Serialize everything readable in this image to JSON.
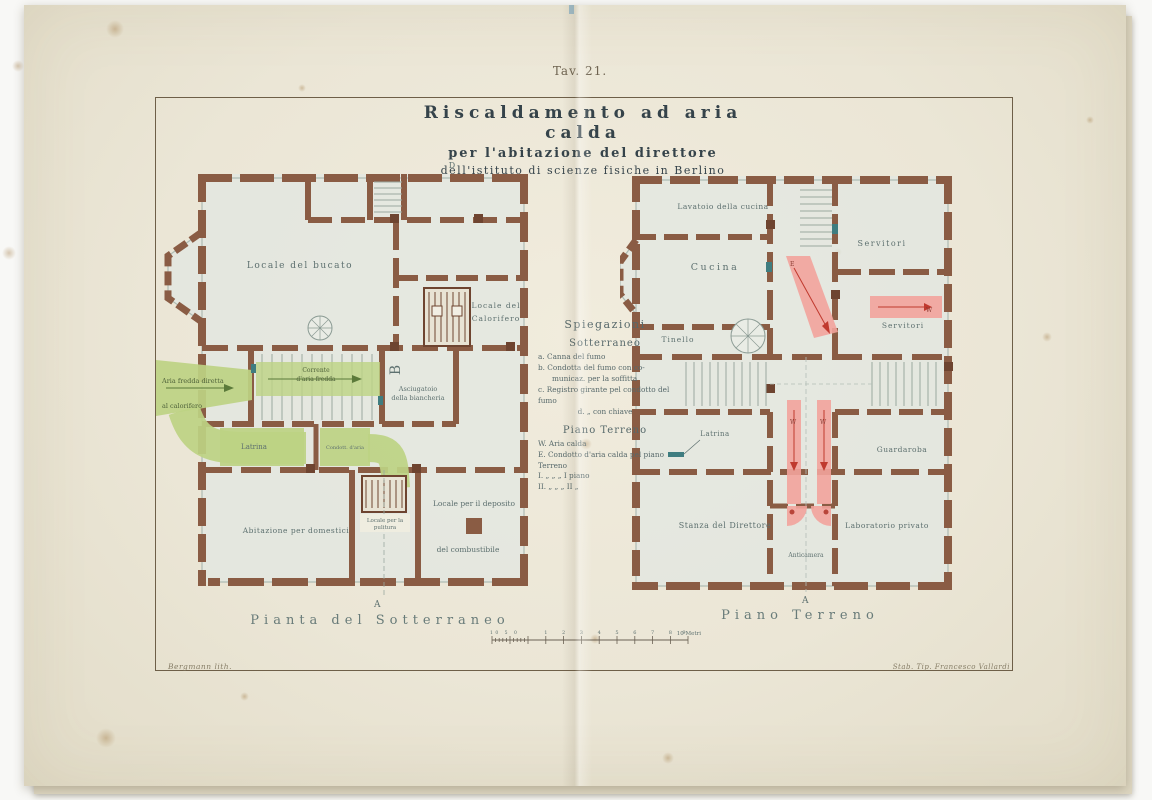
{
  "plate": {
    "tav_label": "Tav. 21.",
    "title": "Riscaldamento ad aria calda",
    "subtitle1": "per l'abitazione del direttore",
    "subtitle2": "dell'istituto di scienze fisiche in Berlino"
  },
  "legend": {
    "heading": "Spiegazioni",
    "sotterraneo": {
      "title": "Sotterraneo",
      "line_a": "a. Canna del fumo",
      "line_b1": "b. Condotta del fumo con co-",
      "line_b2": "municaz. per la soffitta",
      "line_c": "c. Registro girante pel condotto del fumo",
      "line_d": "d.  „  con chiave"
    },
    "piano_terreno": {
      "title": "Piano Terreno",
      "line_w": "W. Aria calda",
      "line_e": "E. Condotto d'aria calda pel piano Terreno",
      "line_i": "I.   „    „    „   I piano",
      "line_ii": "II.   „    „    „   II  „"
    }
  },
  "basement": {
    "caption": "Pianta  del  Sotterraneo",
    "marker_top": "D",
    "marker_bottom": "A",
    "marker_b": "B",
    "rooms": {
      "bucato": "Locale del bucato",
      "calorifero1": "Locale del",
      "calorifero2": "Calorifero",
      "asciugatoio1": "Asciugatoio",
      "asciugatoio2": "della biancheria",
      "latrina": "Latrina",
      "abitazione": "Abitazione per domestici",
      "pulitura1": "Locale per la",
      "pulitura2": "pulitura",
      "deposito1": "Locale per il deposito",
      "deposito2": "del combustibile"
    },
    "ducts": {
      "aria1": "Aria fredda diretta",
      "aria2": "al calorifero",
      "corrente1": "Corrente",
      "corrente2": "d'aria fredda",
      "condotto": "Condott. d'aria"
    }
  },
  "ground": {
    "caption": "Piano  Terreno",
    "marker_bottom": "A",
    "rooms": {
      "lavatoio": "Lavatoio della cucina",
      "cucina": "Cucina",
      "servitori1": "Servitori",
      "servitori2": "Servitori",
      "tinello": "Tinello",
      "latrina": "Latrina",
      "guardaroba": "Guardaroba",
      "stanza": "Stanza del Direttore",
      "anticamera": "Anticamera",
      "laboratorio": "Laboratorio privato"
    },
    "duct_letters": {
      "w1": "W",
      "w2": "W",
      "w3": "W",
      "e1": "E"
    }
  },
  "scale": {
    "sub_label": "10 5 0",
    "numbers": [
      "1",
      "2",
      "3",
      "4",
      "5",
      "6",
      "7",
      "8",
      "9"
    ],
    "unit": "10 Metri"
  },
  "credits": {
    "left": "Bergmann lith.",
    "right": "Stab. Tip. Francesco Vallardi"
  },
  "colors": {
    "paper": "#ebe6d6",
    "wall_brown": "#8a5c44",
    "cold_air_green": "#bdd383",
    "warm_air_pink": "#f2a39c",
    "ink": "#35434a",
    "label_ink": "#5d706f"
  }
}
